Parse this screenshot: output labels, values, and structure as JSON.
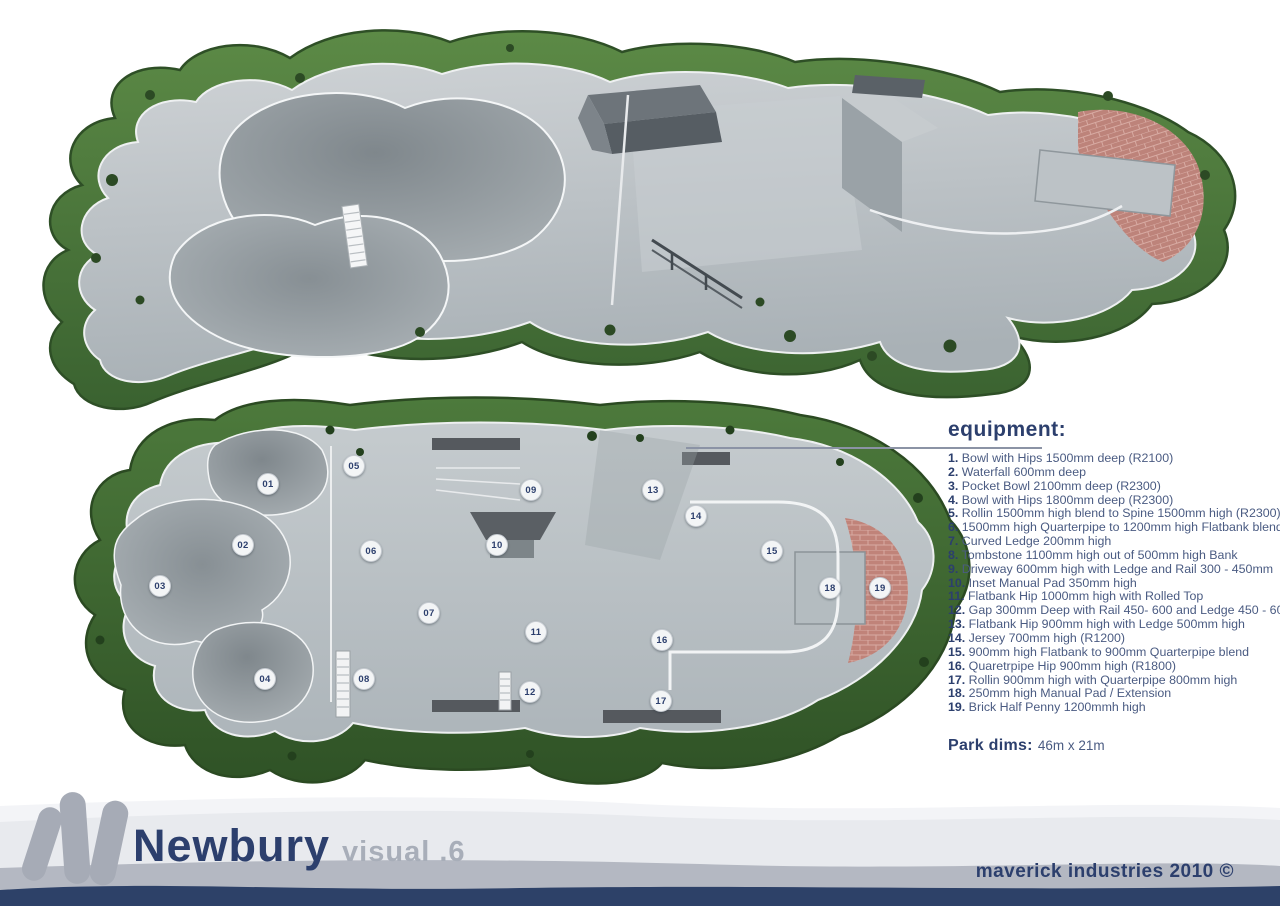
{
  "equipment": {
    "heading": "equipment:",
    "items": [
      {
        "n": "1.",
        "text": "Bowl with Hips 1500mm deep (R2100)"
      },
      {
        "n": "2.",
        "text": "Waterfall 600mm deep"
      },
      {
        "n": "3.",
        "text": "Pocket Bowl 2100mm deep (R2300)"
      },
      {
        "n": "4.",
        "text": "Bowl with Hips 1800mm deep (R2300)"
      },
      {
        "n": "5.",
        "text": "Rollin 1500mm high blend to Spine 1500mm high (R2300)"
      },
      {
        "n": "6.",
        "text": "1500mm high Quarterpipe to 1200mm high Flatbank blend"
      },
      {
        "n": "7.",
        "text": "Curved Ledge 200mm high"
      },
      {
        "n": "8.",
        "text": "Tombstone 1100mm high out of 500mm high Bank"
      },
      {
        "n": "9.",
        "text": "Driveway 600mm high with Ledge and Rail 300 - 450mm"
      },
      {
        "n": "10.",
        "text": "Inset Manual Pad 350mm high"
      },
      {
        "n": "11.",
        "text": "Flatbank Hip 1000mm high with Rolled Top"
      },
      {
        "n": "12.",
        "text": "Gap 300mm Deep with Rail 450- 600 and Ledge 450 - 600"
      },
      {
        "n": "13.",
        "text": "Flatbank Hip 900mm high with Ledge 500mm high"
      },
      {
        "n": "14.",
        "text": "Jersey 700mm high (R1200)"
      },
      {
        "n": "15.",
        "text": "900mm high Flatbank to 900mm Quarterpipe blend"
      },
      {
        "n": "16.",
        "text": "Quaretrpipe Hip 900mm high (R1800)"
      },
      {
        "n": "17.",
        "text": "Rollin 900mm high with Quarterpipe 800mm high"
      },
      {
        "n": "18.",
        "text": "250mm high Manual Pad / Extension"
      },
      {
        "n": "19.",
        "text": "Brick Half Penny 1200mmh high"
      }
    ]
  },
  "park": {
    "dims_label": "Park dims:",
    "dims_value": "46m x 21m"
  },
  "plan": {
    "markers": [
      {
        "label": "01",
        "x": 268,
        "y": 484
      },
      {
        "label": "02",
        "x": 243,
        "y": 545
      },
      {
        "label": "03",
        "x": 160,
        "y": 586
      },
      {
        "label": "04",
        "x": 265,
        "y": 679
      },
      {
        "label": "05",
        "x": 354,
        "y": 466
      },
      {
        "label": "06",
        "x": 371,
        "y": 551
      },
      {
        "label": "07",
        "x": 429,
        "y": 613
      },
      {
        "label": "08",
        "x": 364,
        "y": 679
      },
      {
        "label": "09",
        "x": 531,
        "y": 490
      },
      {
        "label": "10",
        "x": 497,
        "y": 545
      },
      {
        "label": "11",
        "x": 536,
        "y": 632
      },
      {
        "label": "12",
        "x": 530,
        "y": 692
      },
      {
        "label": "13",
        "x": 653,
        "y": 490
      },
      {
        "label": "14",
        "x": 696,
        "y": 516
      },
      {
        "label": "15",
        "x": 772,
        "y": 551
      },
      {
        "label": "16",
        "x": 662,
        "y": 640
      },
      {
        "label": "17",
        "x": 661,
        "y": 701
      },
      {
        "label": "18",
        "x": 830,
        "y": 588
      },
      {
        "label": "19",
        "x": 880,
        "y": 588
      }
    ]
  },
  "footer": {
    "title": "Newbury",
    "subtitle": "visual .6",
    "credit": "maverick industries 2010 ©"
  },
  "colors": {
    "navy": "#2c3f6d",
    "list_text": "#4a5b82",
    "grass": "#4a7a3a",
    "concrete": "#bcc3c7",
    "brick": "#bd837a",
    "band_light": "#e8eaee",
    "band_gray": "#b4b8c2",
    "logo_gray": "#a6abb6"
  }
}
